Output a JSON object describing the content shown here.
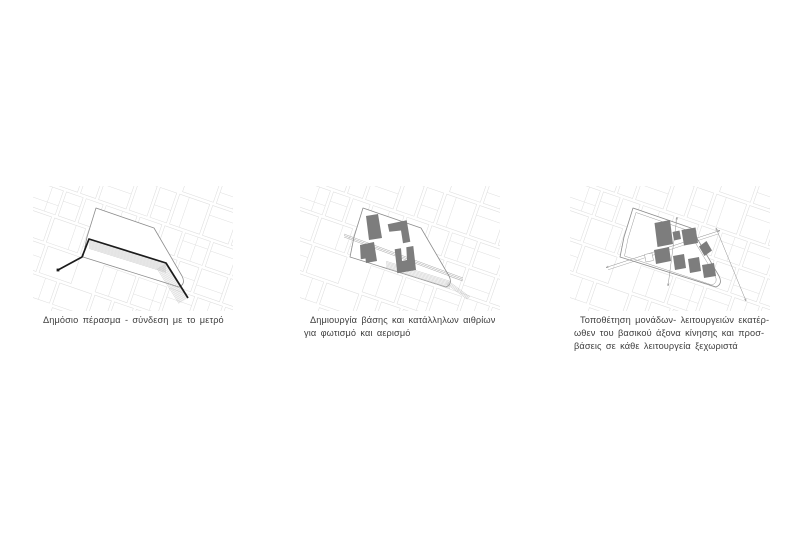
{
  "page": {
    "background": "#ffffff",
    "width": 800,
    "height": 535
  },
  "figure": {
    "kind": "architectural-concept-diagram-sequence",
    "colors": {
      "street": "#dedede",
      "site_outline": "#8c8c8c",
      "passage": "#1b1b1b",
      "hatch": "#b2b2b2",
      "building": "#7d7d7d",
      "axis": "#8f8f8f",
      "caption_text": "#3e3e3e"
    },
    "panels": [
      {
        "id": "step-1",
        "caption_lines": [
          "Δημόσιο πέρασμα - σύνδεση με το μετρό"
        ]
      },
      {
        "id": "step-2",
        "caption_lines": [
          "Δημιουργία βάσης και κατάλληλων αιθρίων",
          "για φωτισμό και αερισμό"
        ]
      },
      {
        "id": "step-3",
        "caption_lines": [
          "Τοποθέτηση μονάδων- λειτουργειών εκατέρ-",
          "ωθεν του βασικού άξονα κίνησης και προσ-",
          "βάσεις σε κάθε λειτουργεία ξεχωριστά"
        ]
      }
    ]
  }
}
